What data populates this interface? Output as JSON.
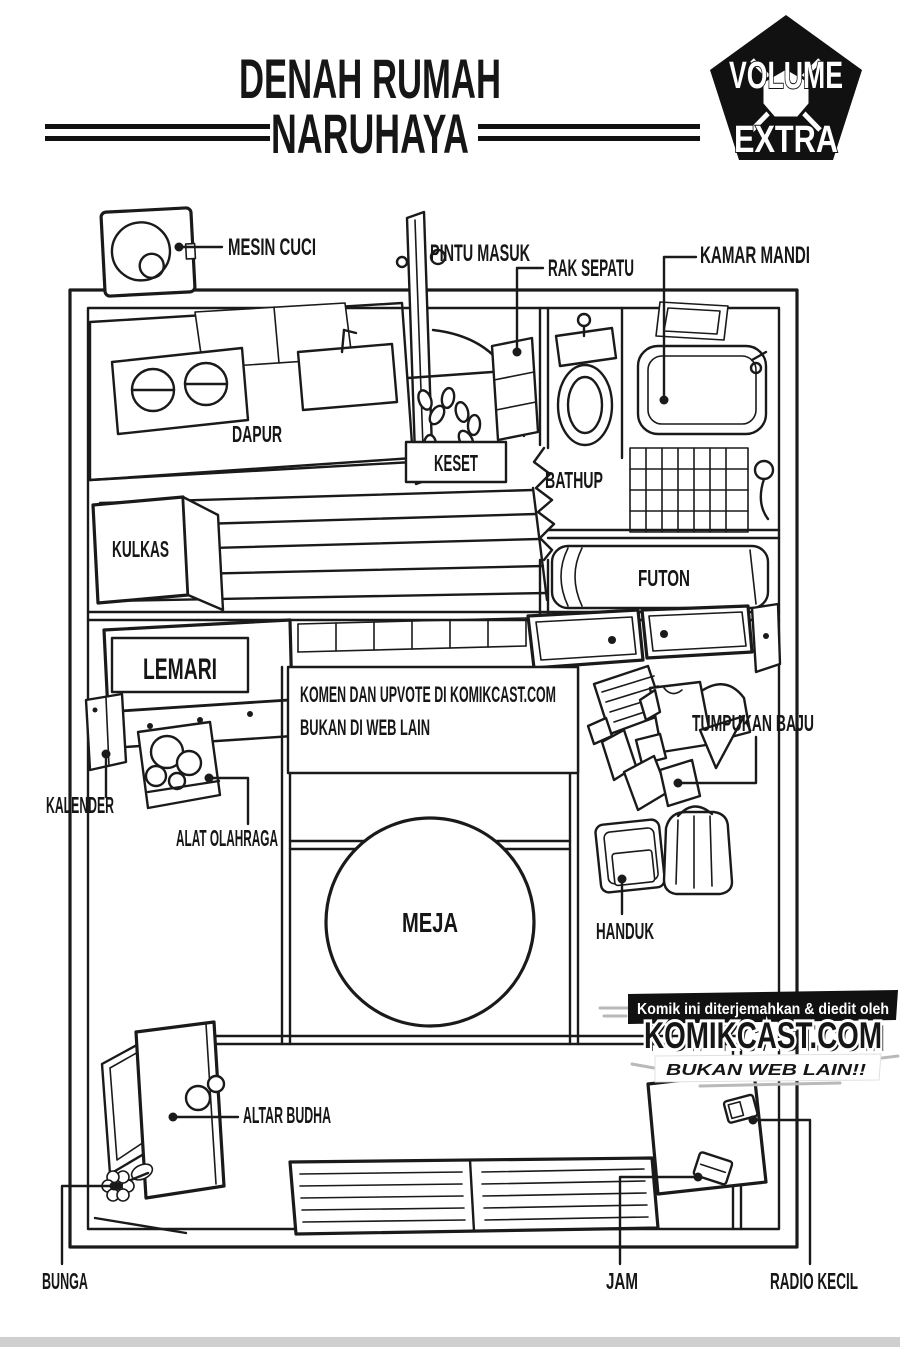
{
  "header": {
    "title_line1": "DENAH RUMAH",
    "title_line2": "NARUHAYA"
  },
  "badge": {
    "top": "VOLUME",
    "bottom": "EXTRA"
  },
  "plan_labels": {
    "mesin_cuci": "MESIN CUCI",
    "pintu_masuk": "PINTU MASUK",
    "rak_sepatu": "RAK SEPATU",
    "kamar_mandi": "KAMAR MANDI",
    "dapur": "DAPUR",
    "keset": "KESET",
    "bathup": "BATHUP",
    "kulkas": "KULKAS",
    "futon": "FUTON",
    "lemari": "LEMARI",
    "kalender": "KALENDER",
    "alat_olahraga": "ALAT OLAHRAGA",
    "tumpukan_baju": "TUMPUKAN BAJU",
    "meja": "MEJA",
    "handuk": "HANDUK",
    "altar_budha": "ALTAR BUDHA",
    "bunga": "BUNGA",
    "jam": "JAM",
    "radio_kecil": "RADIO KECIL"
  },
  "watermark": {
    "line1": "KOMEN DAN UPVOTE DI KOMIKCAST.COM",
    "line2": "BUKAN DI WEB LAIN"
  },
  "credit": {
    "tagline": "Komik ini diterjemahkan & diedit oleh",
    "site": "KOMIKCAST.COM",
    "slogan": "BUKAN WEB LAIN!!"
  },
  "colors": {
    "ink": "#1a1a1a",
    "band_black": "#111111",
    "site_blue": "#2f8fdd",
    "site_shadow": "#8e959c",
    "slogan_red": "#d63230",
    "bottom_strip": "#cfcfcf"
  }
}
